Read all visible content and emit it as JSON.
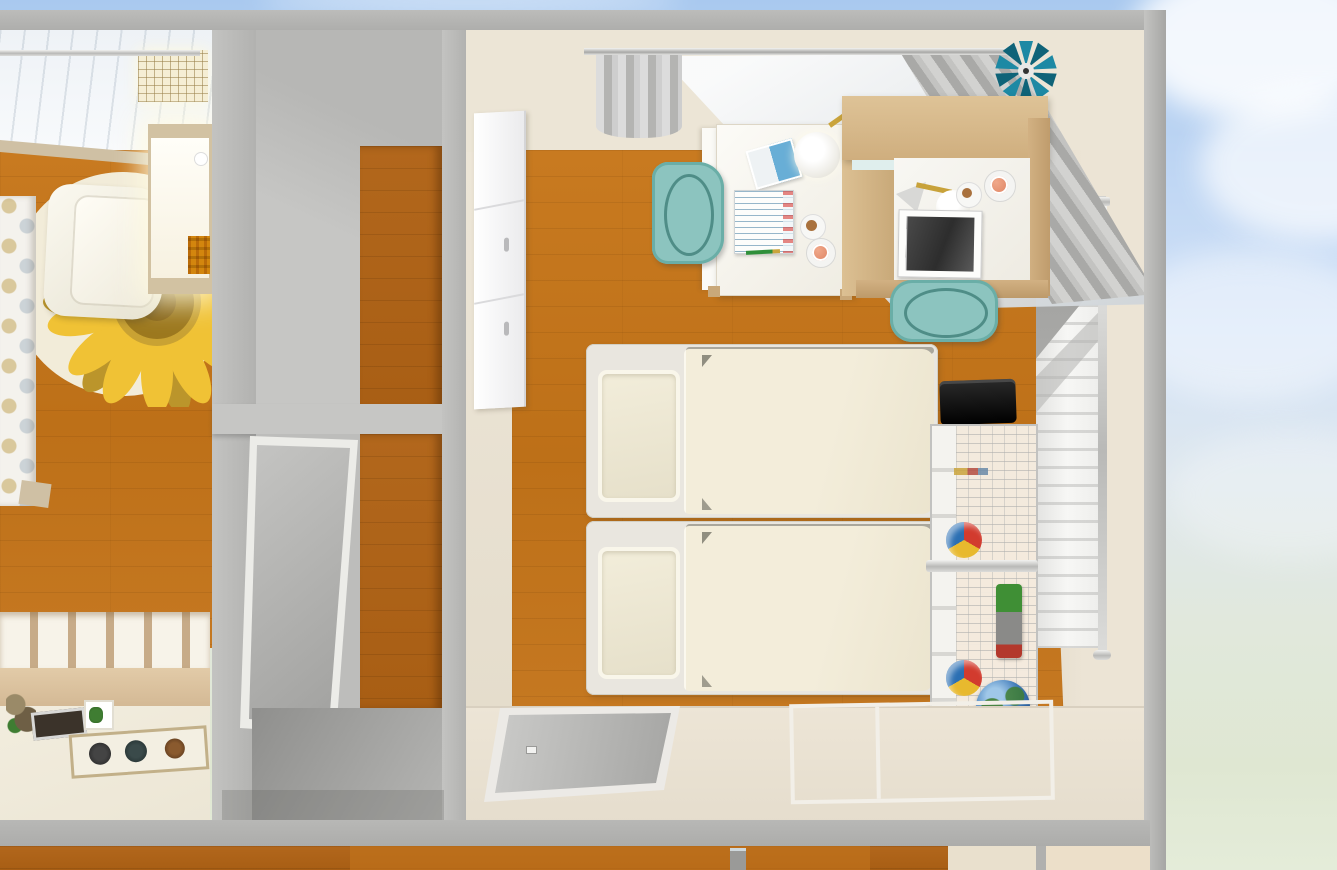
{
  "scene": {
    "description": "Top-down 3D dollhouse cutaway view of a home interior: a playroom with a sunflower rug, a hallway, and a children's bedroom with two twin beds, two desks with teal chairs and a wire toy rack. Sky visible beyond the outer wall.",
    "sky": {
      "top_color": "#a9c9ef",
      "bottom_color": "#e4ecd9",
      "cloud_color": "#ffffff",
      "cloud_count": 4
    },
    "palette": {
      "outer_wall_gray": "#b4b4b2",
      "interior_wall_beige": "#ebe3d4",
      "wood_floor": "#c2741c",
      "hallway_floor_gray": "#a3a3a1",
      "rug_base": "#f2ecd9",
      "sunflower_yellow": "#f0c235",
      "sunflower_center": "#9c781e",
      "sofa_white": "#f7f4e8",
      "bed_duvet_cream": "#f0ead6",
      "bed_pillow": "#f1ecd9",
      "desk_white": "#f5f4f0",
      "desk_beech": "#d6ba8e",
      "chair_teal": "#8cc4bf",
      "curtain_gray": "#bdbdbb",
      "sheer_white": "#f4f6f8",
      "blind_white": "#f6f6f4",
      "mat_cream": "#f0ebdd",
      "shelf_tan": "#cdb190",
      "toy_ball": [
        "#d23b2e",
        "#e8b92e",
        "#2b6fb3"
      ],
      "toy_truck_green": "#3f8f35",
      "globe_blue": "#2f6db3",
      "pinwheel_teal": "#1d89a4",
      "mug_peach": "#e08a6a",
      "pencil_green": "#2f8f3a",
      "case_black": "#111111"
    },
    "rooms": [
      {
        "id": "playroom",
        "furniture": [
          "ceiling-light-panel",
          "curtain-rod",
          "polka-dot-curtain",
          "sunflower-rug",
          "sofa",
          "side-table",
          "plaid-cushion",
          "cubby-shelf",
          "play-mat",
          "plush-toy",
          "toy-tray",
          "toy-box",
          "play-board"
        ]
      },
      {
        "id": "hallway",
        "furniture": [
          "wood-door-panel",
          "gray-sliding-door"
        ]
      },
      {
        "id": "bedroom",
        "furniture": [
          "curtain-rod",
          "gray-curtain-left",
          "sheer-curtain",
          "gray-curtain-right",
          "pinwheel-ornament",
          "white-wardrobe",
          "white-desk",
          "teal-chair-left",
          "beech-desk-with-hutch",
          "teal-chair-right",
          "desk-lamp-left",
          "desk-lamp-right",
          "open-book",
          "notebook",
          "photo-book",
          "coffee-cup-left",
          "coffee-cup-right",
          "cookie-plate-left",
          "cookie-plate-right",
          "green-pencil",
          "twin-bed-upper",
          "twin-bed-lower",
          "wire-storage-rack",
          "black-case",
          "toy-ball-upper",
          "toy-ball-lower",
          "toy-truck",
          "globe",
          "window-roman-blind",
          "gray-sliding-door",
          "sliding-door-frame"
        ]
      }
    ],
    "counts": {
      "beds": 2,
      "desks": 2,
      "chairs": 2,
      "rugs": 1,
      "toy_balls": 2
    },
    "labels": {
      "playroom": "playroom",
      "hallway": "hallway",
      "bedroom": "children bedroom",
      "sofa": "white sofa",
      "rug": "sunflower rug",
      "table": "side table",
      "curtain": "polka dot curtain",
      "shelf": "cubby toy shelf",
      "mat": "cream play mat",
      "board": "toy play board",
      "wood_door": "wood door panel",
      "sliding_door": "gray sliding door",
      "wardrobe": "white wardrobe",
      "sheer": "sheer curtain",
      "gray_curtain": "gray curtain",
      "pinwheel": "teal pinwheel ornament",
      "desk_left": "white desk",
      "desk_right": "beech desk with hutch",
      "chair": "teal desk chair",
      "bed_upper": "twin bed upper",
      "bed_lower": "twin bed lower",
      "rack": "wire storage rack",
      "ball": "toy ball",
      "truck": "toy truck",
      "globe": "globe",
      "case": "black case",
      "blind": "window roman blind",
      "lamp": "desk lamp",
      "notebook": "notebook",
      "book": "open book",
      "photo_book": "photo book",
      "cup": "coffee cup",
      "plate": "cookie plate",
      "pencil": "green pencil"
    }
  }
}
